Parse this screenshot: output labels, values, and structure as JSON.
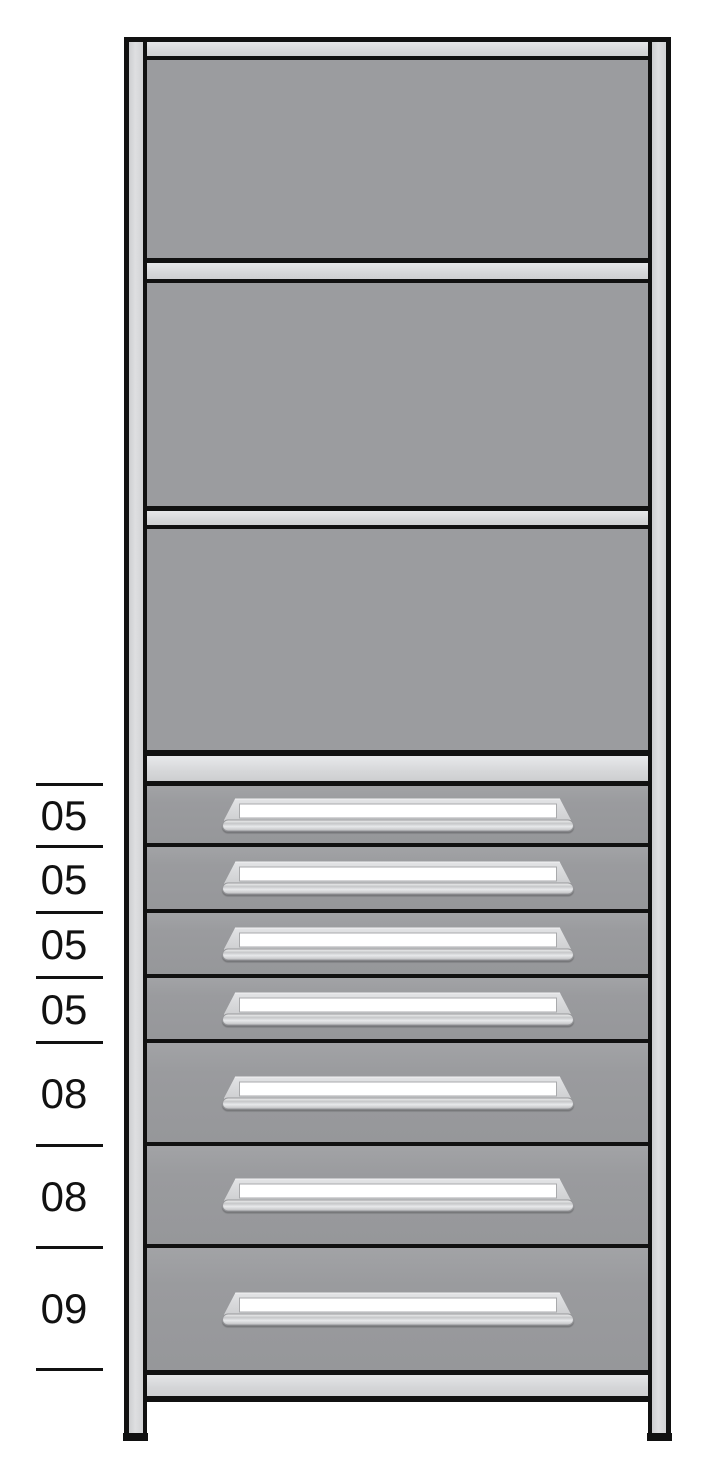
{
  "shelving_unit": {
    "open_shelf_sections": 3,
    "drawer_count": 7,
    "drawers": [
      {
        "size_label": "05"
      },
      {
        "size_label": "05"
      },
      {
        "size_label": "05"
      },
      {
        "size_label": "05"
      },
      {
        "size_label": "08"
      },
      {
        "size_label": "08"
      },
      {
        "size_label": "09"
      }
    ]
  },
  "colors": {
    "background": "#ffffff",
    "outline": "#111111",
    "panel_gray": "#9b9c9f",
    "frame_light_gray": "#dcdddf",
    "post_gray": "#d5d6d8",
    "drawer_gray": "#9c9da0",
    "handle_gray": "#d9dadc",
    "handle_label_white": "#ffffff",
    "dimension_text": "#111111"
  }
}
